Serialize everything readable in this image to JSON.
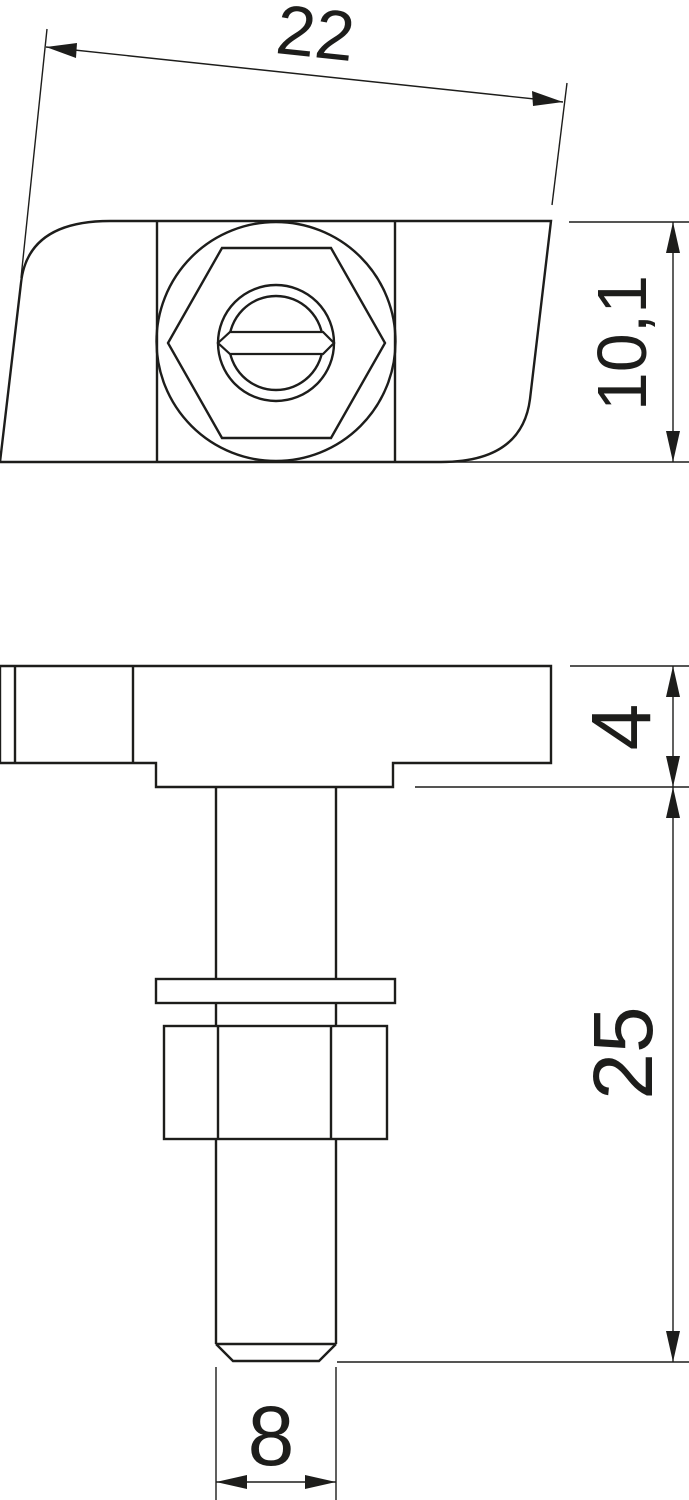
{
  "drawing": {
    "title": "hammer-head-screw-technical-drawing",
    "background_color": "#ffffff",
    "line_color": "#1d1d1b",
    "views": {
      "top_view": "plan-view-of-hammer-head-with-slotted-hex-screw",
      "side_view": "side-view-of-head-shank-washer-and-hex-nut"
    },
    "dimensions": {
      "head_width": {
        "label": "22"
      },
      "head_depth": {
        "label": "10,1"
      },
      "head_thickness": {
        "label": "4"
      },
      "shank_length": {
        "label": "25"
      },
      "tip_diameter": {
        "label": "8"
      }
    }
  }
}
